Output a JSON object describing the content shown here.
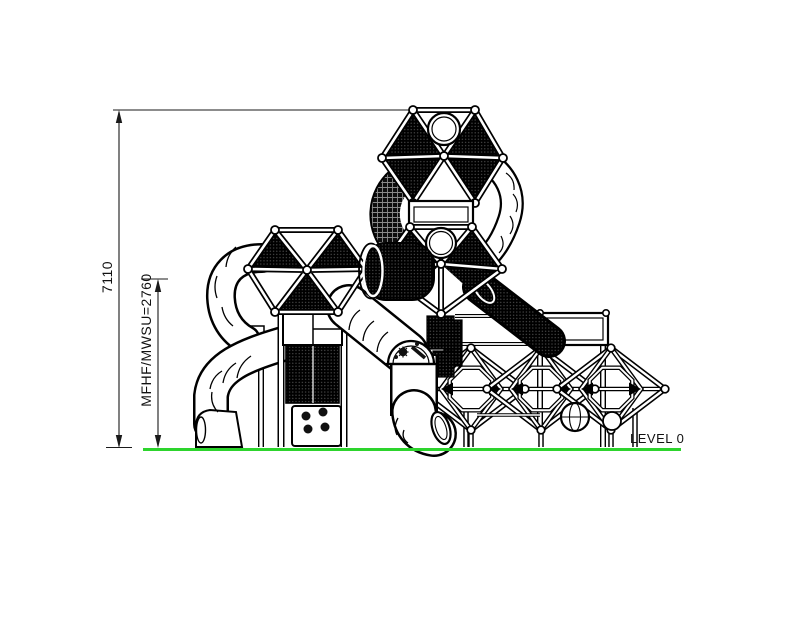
{
  "drawing": {
    "type": "playground-equipment-side-elevation",
    "labels": {
      "overall_height": "7110",
      "fall_height": "MFHF/MWSU=2760",
      "ground_level": "LEVEL 0"
    },
    "colors": {
      "ground_line": "#2dd42d",
      "line_art": "#000000",
      "background": "#ffffff"
    }
  }
}
